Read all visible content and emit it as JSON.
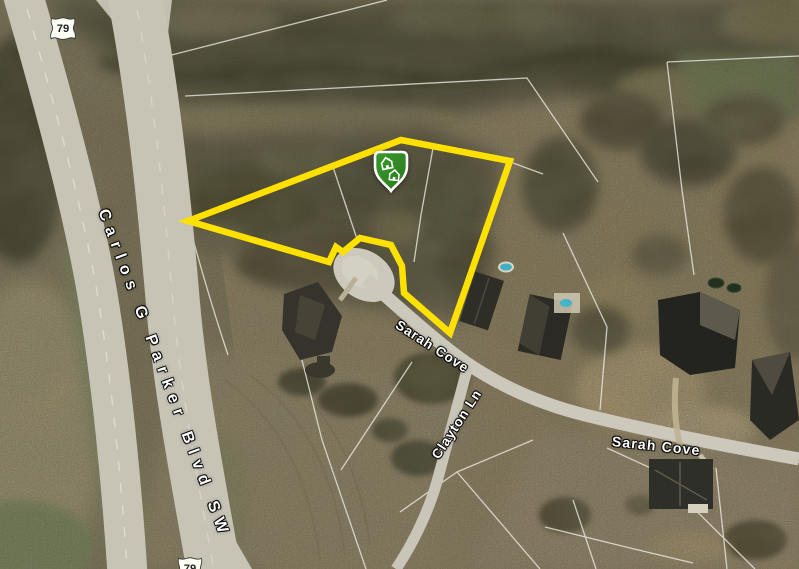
{
  "map": {
    "type": "satellite-imagery",
    "route_shields": {
      "top": "79",
      "bottom": "79"
    },
    "road_labels": {
      "highway": "Carlos G Parker Blvd SW",
      "sarah_cove_upper": "Sarah Cove",
      "clayton_ln": "Clayton Ln",
      "sarah_cove_lower": "Sarah Cove"
    },
    "parcel_boundary": {
      "color": "#FFE100",
      "points": "188,221 401,140 510,161 450,333 404,293 402,266 391,245 360,238 343,252 336,247 329,262"
    },
    "marker": {
      "type": "homes-shield-marker",
      "fill_top": "#3a9a2d",
      "fill_bottom": "#2a7a1c"
    }
  }
}
